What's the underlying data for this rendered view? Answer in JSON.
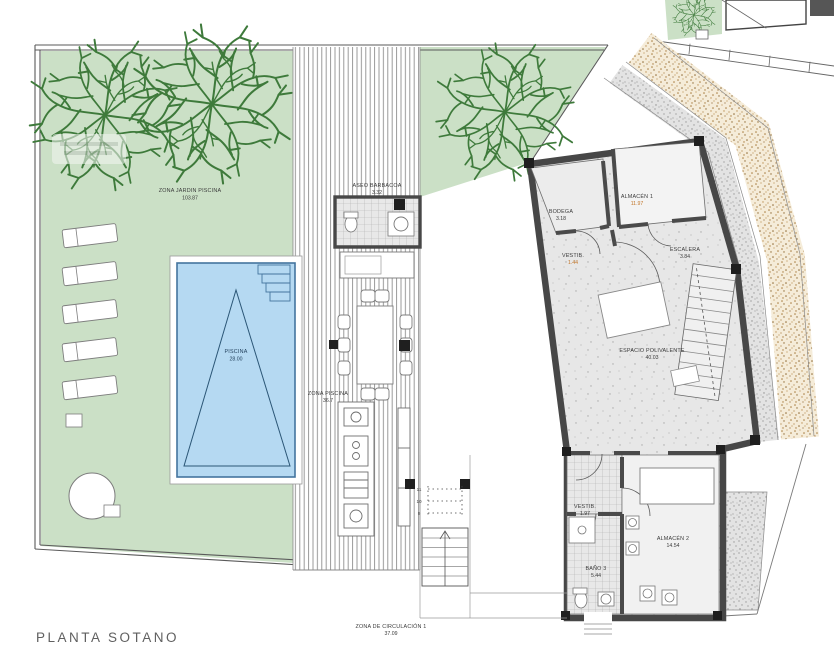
{
  "title": "PLANTA SOTANO",
  "colors": {
    "garden_green": "#cbe0c6",
    "tree_green": "#3e7a3b",
    "pool_blue": "#b5d9f2",
    "pool_edge": "#44749e",
    "wall_dark": "#474747",
    "terrain_brown": "#b5854a",
    "floor_gray": "#e7e7e7",
    "highlight_value": "#c2762a"
  },
  "rooms": {
    "jardin": {
      "name": "ZONA JARDIN PISCINA",
      "area": "103.87"
    },
    "piscina": {
      "name": "PISCINA",
      "area": "28.00"
    },
    "aseo_barbacoa": {
      "name": "ASEO BARBACOA",
      "area": "3.32"
    },
    "zona_piscina": {
      "name": "ZONA PISCINA",
      "area": "36.7"
    },
    "bodega": {
      "name": "BODEGA",
      "area": "3.18"
    },
    "vestibulo_1": {
      "name": "VESTIB.",
      "area": "1.44"
    },
    "almacen_1": {
      "name": "ALMACÉN 1",
      "area": "11.97"
    },
    "escalera": {
      "name": "ESCALERA",
      "area": "3.84"
    },
    "espacio_polivalente": {
      "name": "ESPACIO POLIVALENTE",
      "area": "40.03"
    },
    "vestibulo_2": {
      "name": "VESTIB.",
      "area": "1.97"
    },
    "almacen_2": {
      "name": "ALMACÉN 2",
      "area": "14.54"
    },
    "bano_3": {
      "name": "BAÑO 3",
      "area": "5.44"
    },
    "circulacion": {
      "name": "ZONA DE CIRCULACIÓN 1",
      "area": "37.09"
    }
  },
  "stair_step_numbers": [
    "9",
    "10",
    "11"
  ]
}
